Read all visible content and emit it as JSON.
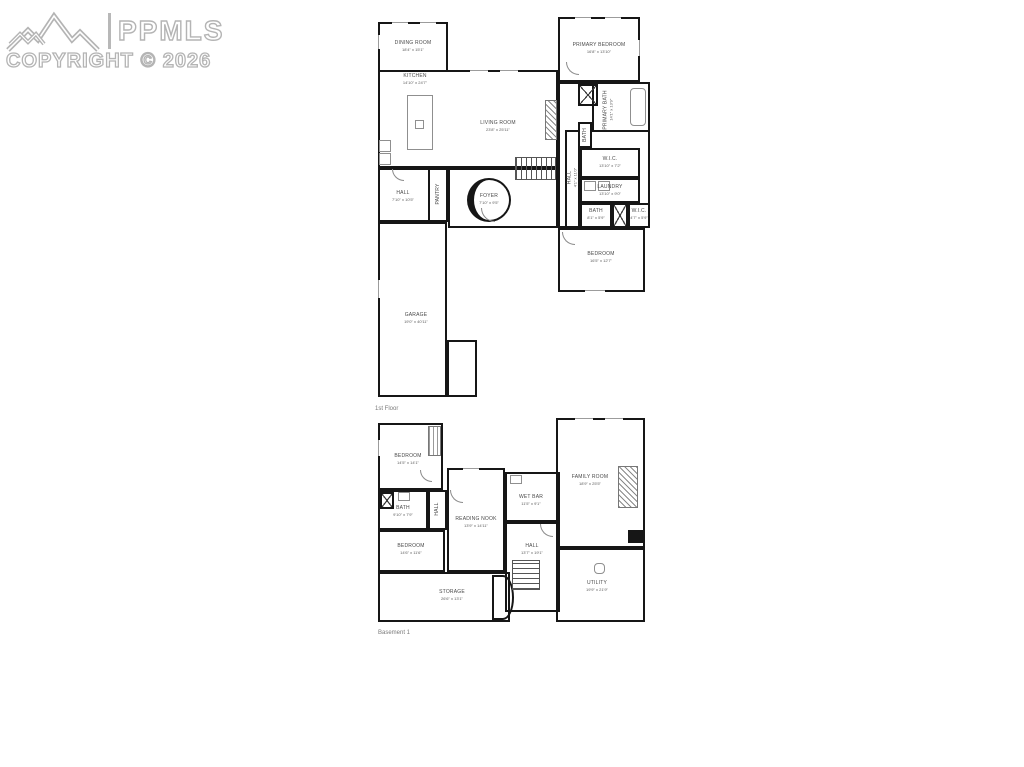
{
  "watermark": {
    "brand": "PPMLS",
    "copyright": "COPYRIGHT © 2026",
    "logo": "mountain-range-icon",
    "color": "#b4b4b4"
  },
  "palette": {
    "wall": "#161616",
    "room_label": "#4a4a4a",
    "floor_label": "#7a7a7a",
    "background": "#ffffff"
  },
  "floors": [
    {
      "label": "1st Floor",
      "rooms": [
        {
          "name": "DINING ROOM",
          "dims": "18'4\" x 15'1\""
        },
        {
          "name": "KITCHEN",
          "dims": "14'10\" x 24'7\""
        },
        {
          "name": "LIVING ROOM",
          "dims": "23'8\" x 25'11\""
        },
        {
          "name": "PRIMARY BEDROOM",
          "dims": "16'8\" x 13'10\""
        },
        {
          "name": "PRIMARY BATH",
          "dims": "14'1\" x 13'9\""
        },
        {
          "name": "HALL",
          "dims": "4'1\" x 11'0\""
        },
        {
          "name": "BATH",
          "dims": "6'1\" x 4'11\""
        },
        {
          "name": "W.I.C.",
          "dims": "13'10\" x 7'2\""
        },
        {
          "name": "LAUNDRY",
          "dims": "13'10\" x 9'0\""
        },
        {
          "name": "BATH",
          "dims": "8'1\" x 5'9\""
        },
        {
          "name": "W.I.C.",
          "dims": "4'7\" x 5'9\""
        },
        {
          "name": "BEDROOM",
          "dims": "16'5\" x 12'7\""
        },
        {
          "name": "FOYER",
          "dims": "7'10\" x 9'5\""
        },
        {
          "name": "HALL",
          "dims": "7'10\" x 10'5\""
        },
        {
          "name": "PANTRY",
          "dims": "4'1\" x 10'5\""
        },
        {
          "name": "GARAGE",
          "dims": "19'0\" x 40'11\""
        }
      ]
    },
    {
      "label": "Basement 1",
      "rooms": [
        {
          "name": "BEDROOM",
          "dims": "14'5\" x 14'1\""
        },
        {
          "name": "BATH",
          "dims": "9'10\" x 7'9\""
        },
        {
          "name": "HALL",
          "dims": "4'1\" x 7'9\""
        },
        {
          "name": "READING NOOK",
          "dims": "13'9\" x 14'11\""
        },
        {
          "name": "WET BAR",
          "dims": "11'5\" x 9'1\""
        },
        {
          "name": "FAMILY ROOM",
          "dims": "18'9\" x 25'5\""
        },
        {
          "name": "HALL",
          "dims": "13'7\" x 19'1\""
        },
        {
          "name": "UTILITY",
          "dims": "19'9\" x 21'9\""
        },
        {
          "name": "BEDROOM",
          "dims": "14'6\" x 11'6\""
        },
        {
          "name": "STORAGE",
          "dims": "26'6\" x 13'1\""
        }
      ]
    }
  ]
}
